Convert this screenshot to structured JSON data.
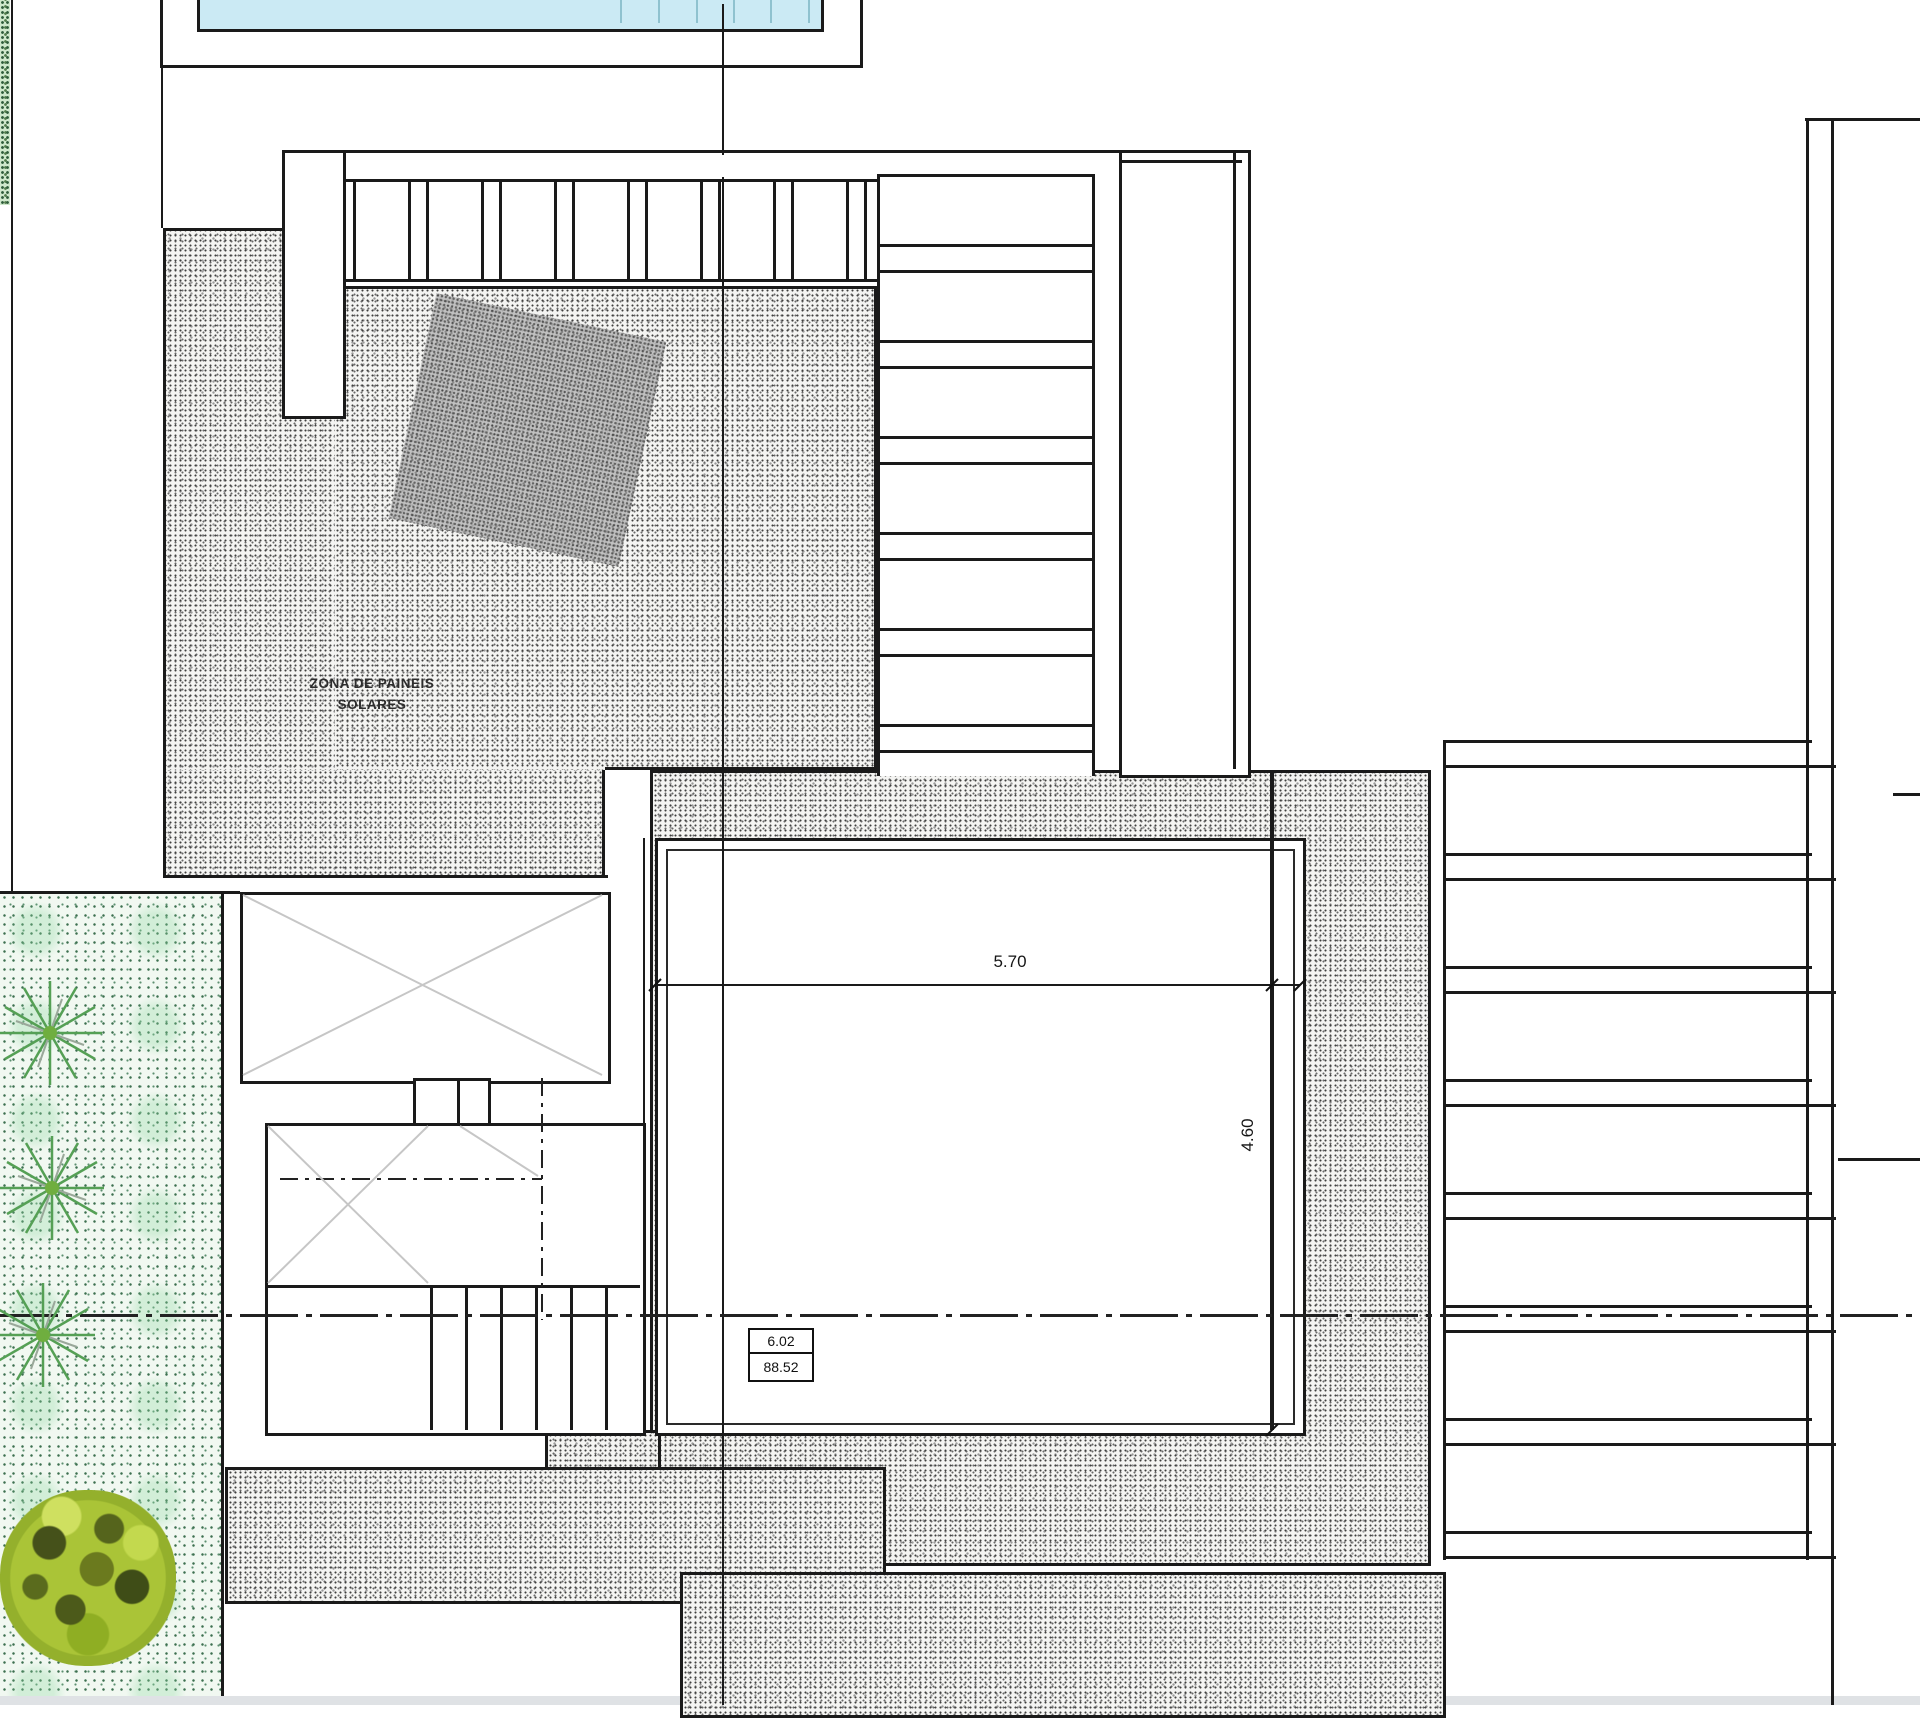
{
  "drawing": {
    "title": "roof-site-plan",
    "labels": {
      "solar_zone_line1": "ZONA DE PAINEIS",
      "solar_zone_line2": "SOLARES"
    },
    "dimensions": {
      "width": "5.70",
      "height": "4.60"
    },
    "level_box": {
      "top": "6.02",
      "bottom": "88.52"
    }
  },
  "colors": {
    "ink": "#1a1a1a",
    "pool": "#cbeaf4",
    "pool_lane": "#8fc2cf",
    "gray_diag": "#c6c6c6",
    "plant_green": "#55a055",
    "grass_dot": "#3d7050",
    "bottom_strip": "#dfe2e5"
  }
}
